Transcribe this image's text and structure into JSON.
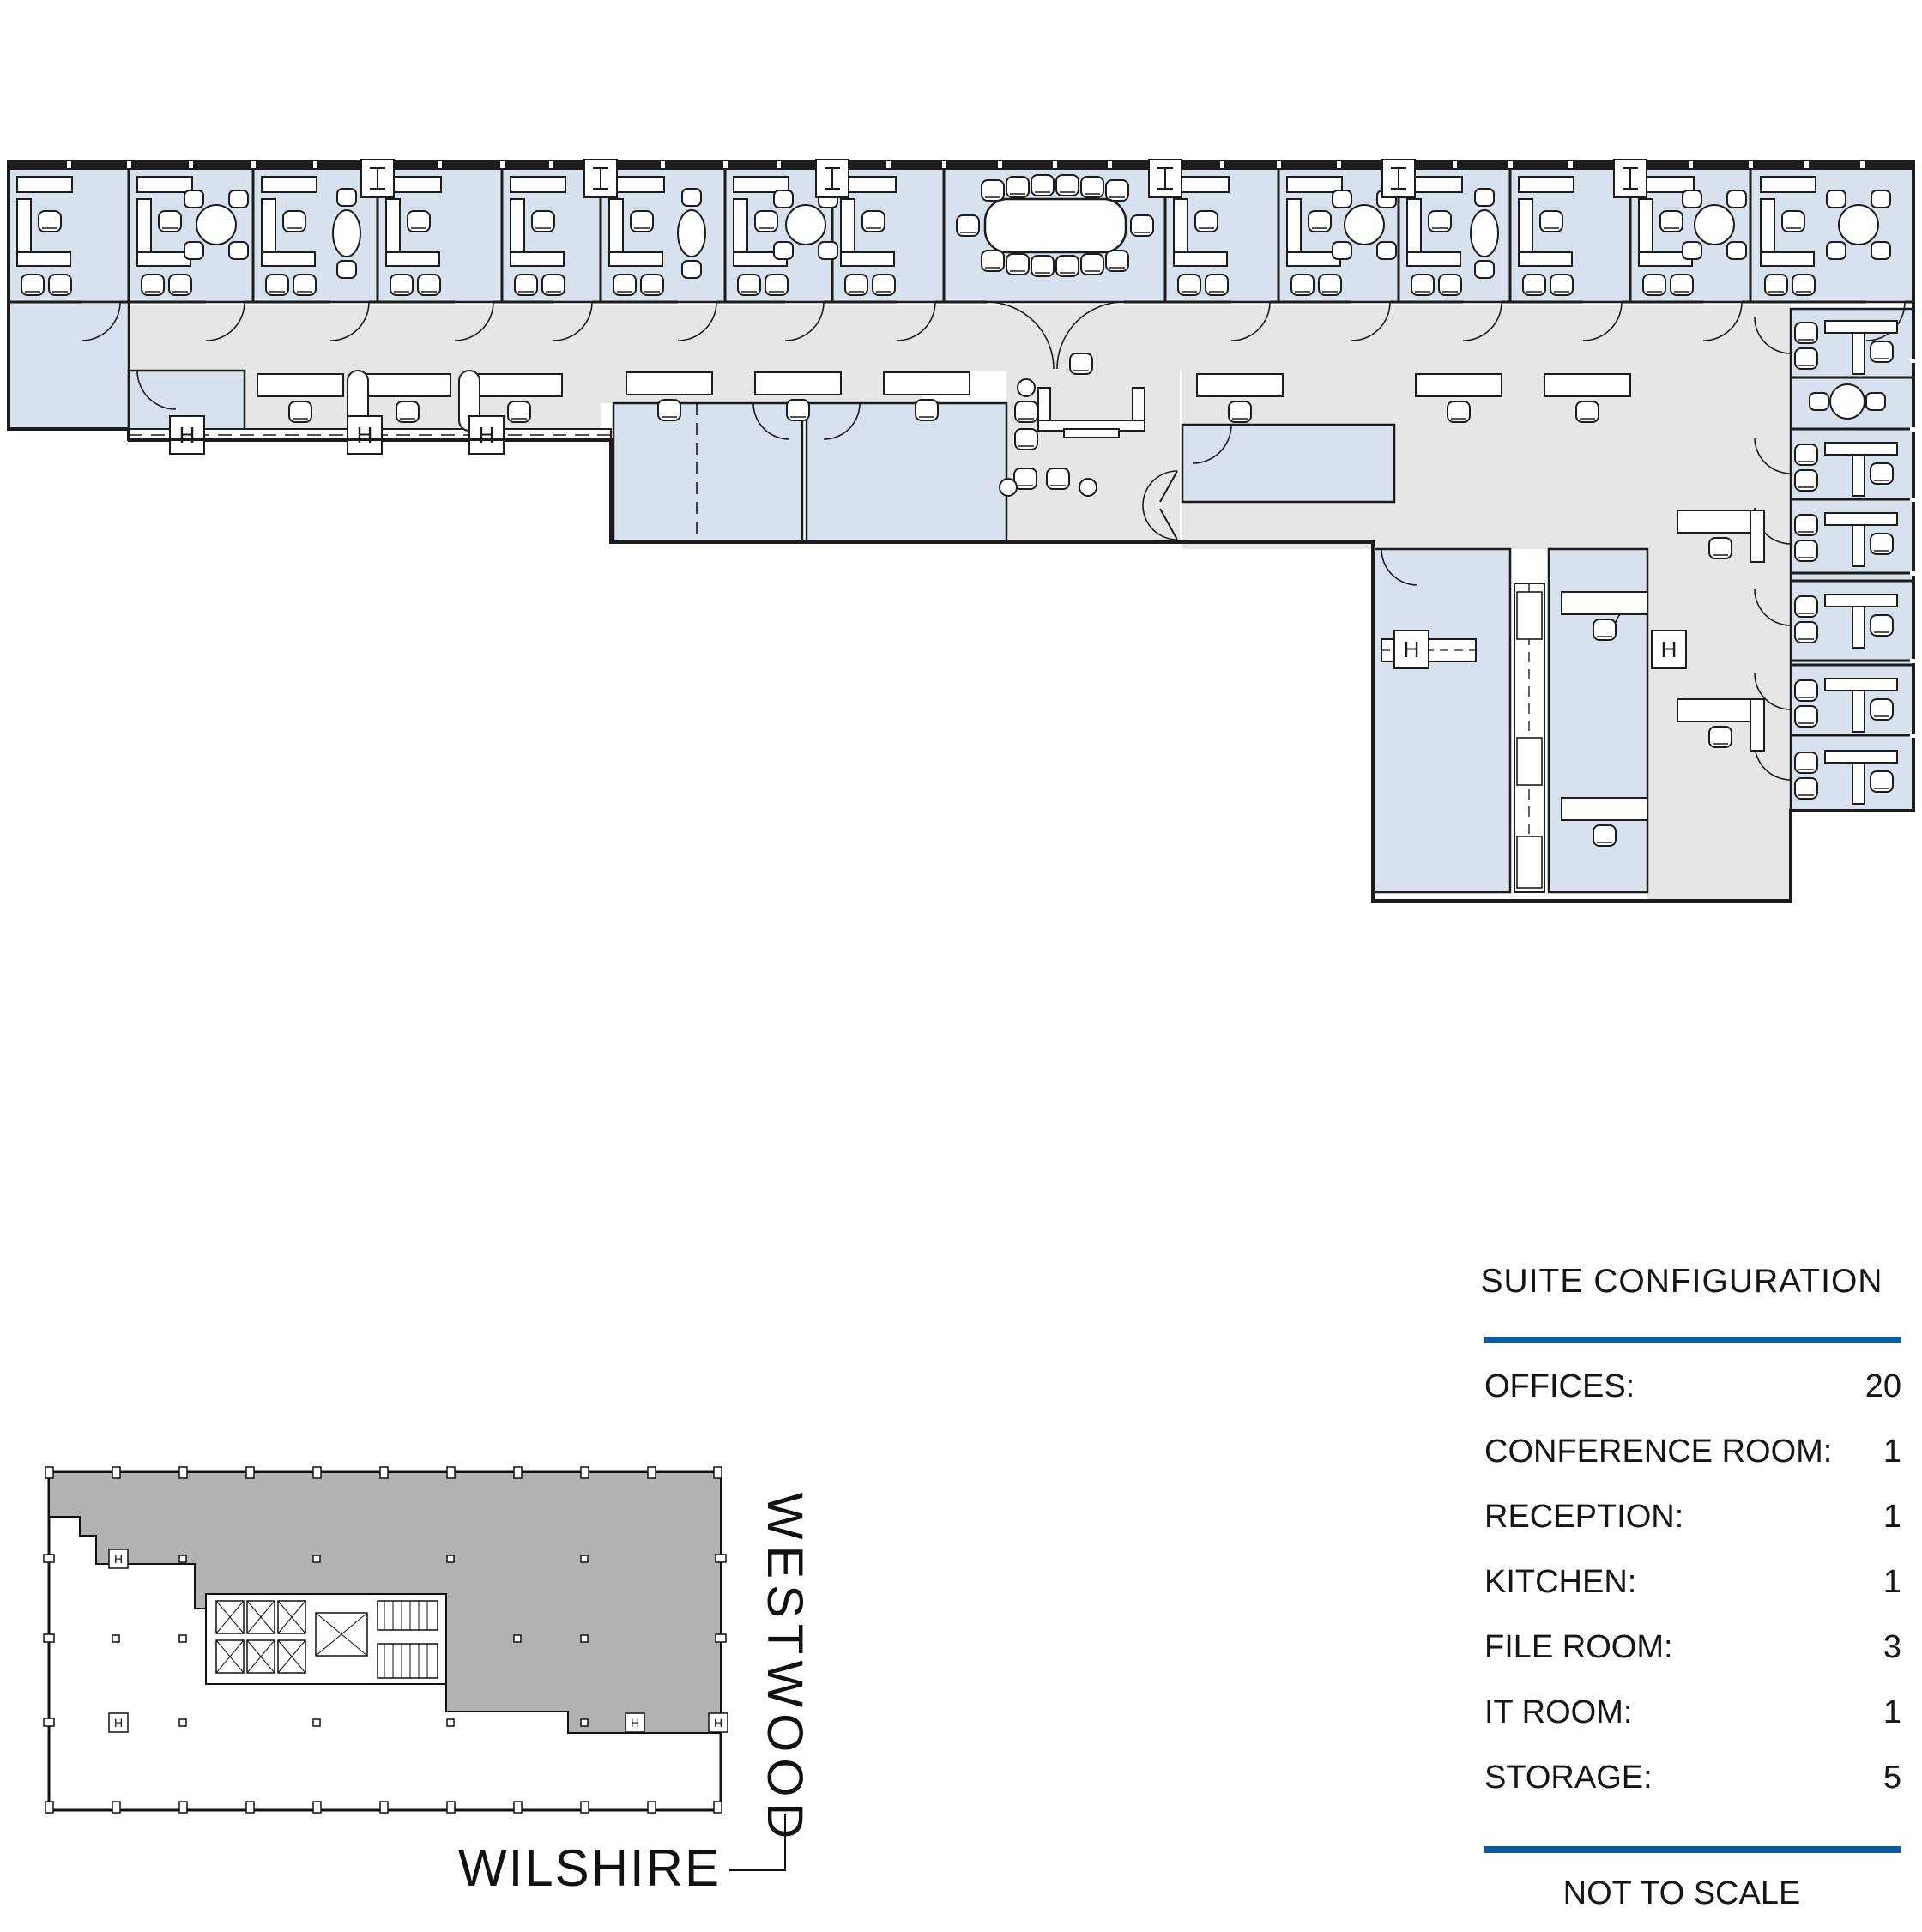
{
  "sheet": {
    "kind": "office suite floor plan sheet",
    "colors": {
      "room_fill": "#d8e2ef",
      "corridor_fill": "#e6e6e6",
      "keyplan_shade": "#b2b2b2",
      "wall": "#1c1c1c",
      "rule_blue": "#0e5b9b",
      "paper": "#ffffff"
    }
  },
  "plan": {
    "column_marker": "H",
    "room_counts": {
      "top_row_offices": 14,
      "right_column_offices": 6,
      "conference_rooms": 1
    }
  },
  "key_plan": {
    "streets": {
      "vertical": "WESTWOOD",
      "horizontal": "WILSHIRE"
    },
    "column_marker": "H"
  },
  "config_table": {
    "title": "SUITE CONFIGURATION",
    "rows": [
      {
        "label": "OFFICES:",
        "value": "20"
      },
      {
        "label": "CONFERENCE ROOM:",
        "value": "1"
      },
      {
        "label": "RECEPTION:",
        "value": "1"
      },
      {
        "label": "KITCHEN:",
        "value": "1"
      },
      {
        "label": "FILE ROOM:",
        "value": "3"
      },
      {
        "label": "IT ROOM:",
        "value": "1"
      },
      {
        "label": "STORAGE:",
        "value": "5"
      }
    ],
    "notes": [
      "NOT TO SCALE",
      "FURNITURE NOT INCLUDED"
    ]
  }
}
